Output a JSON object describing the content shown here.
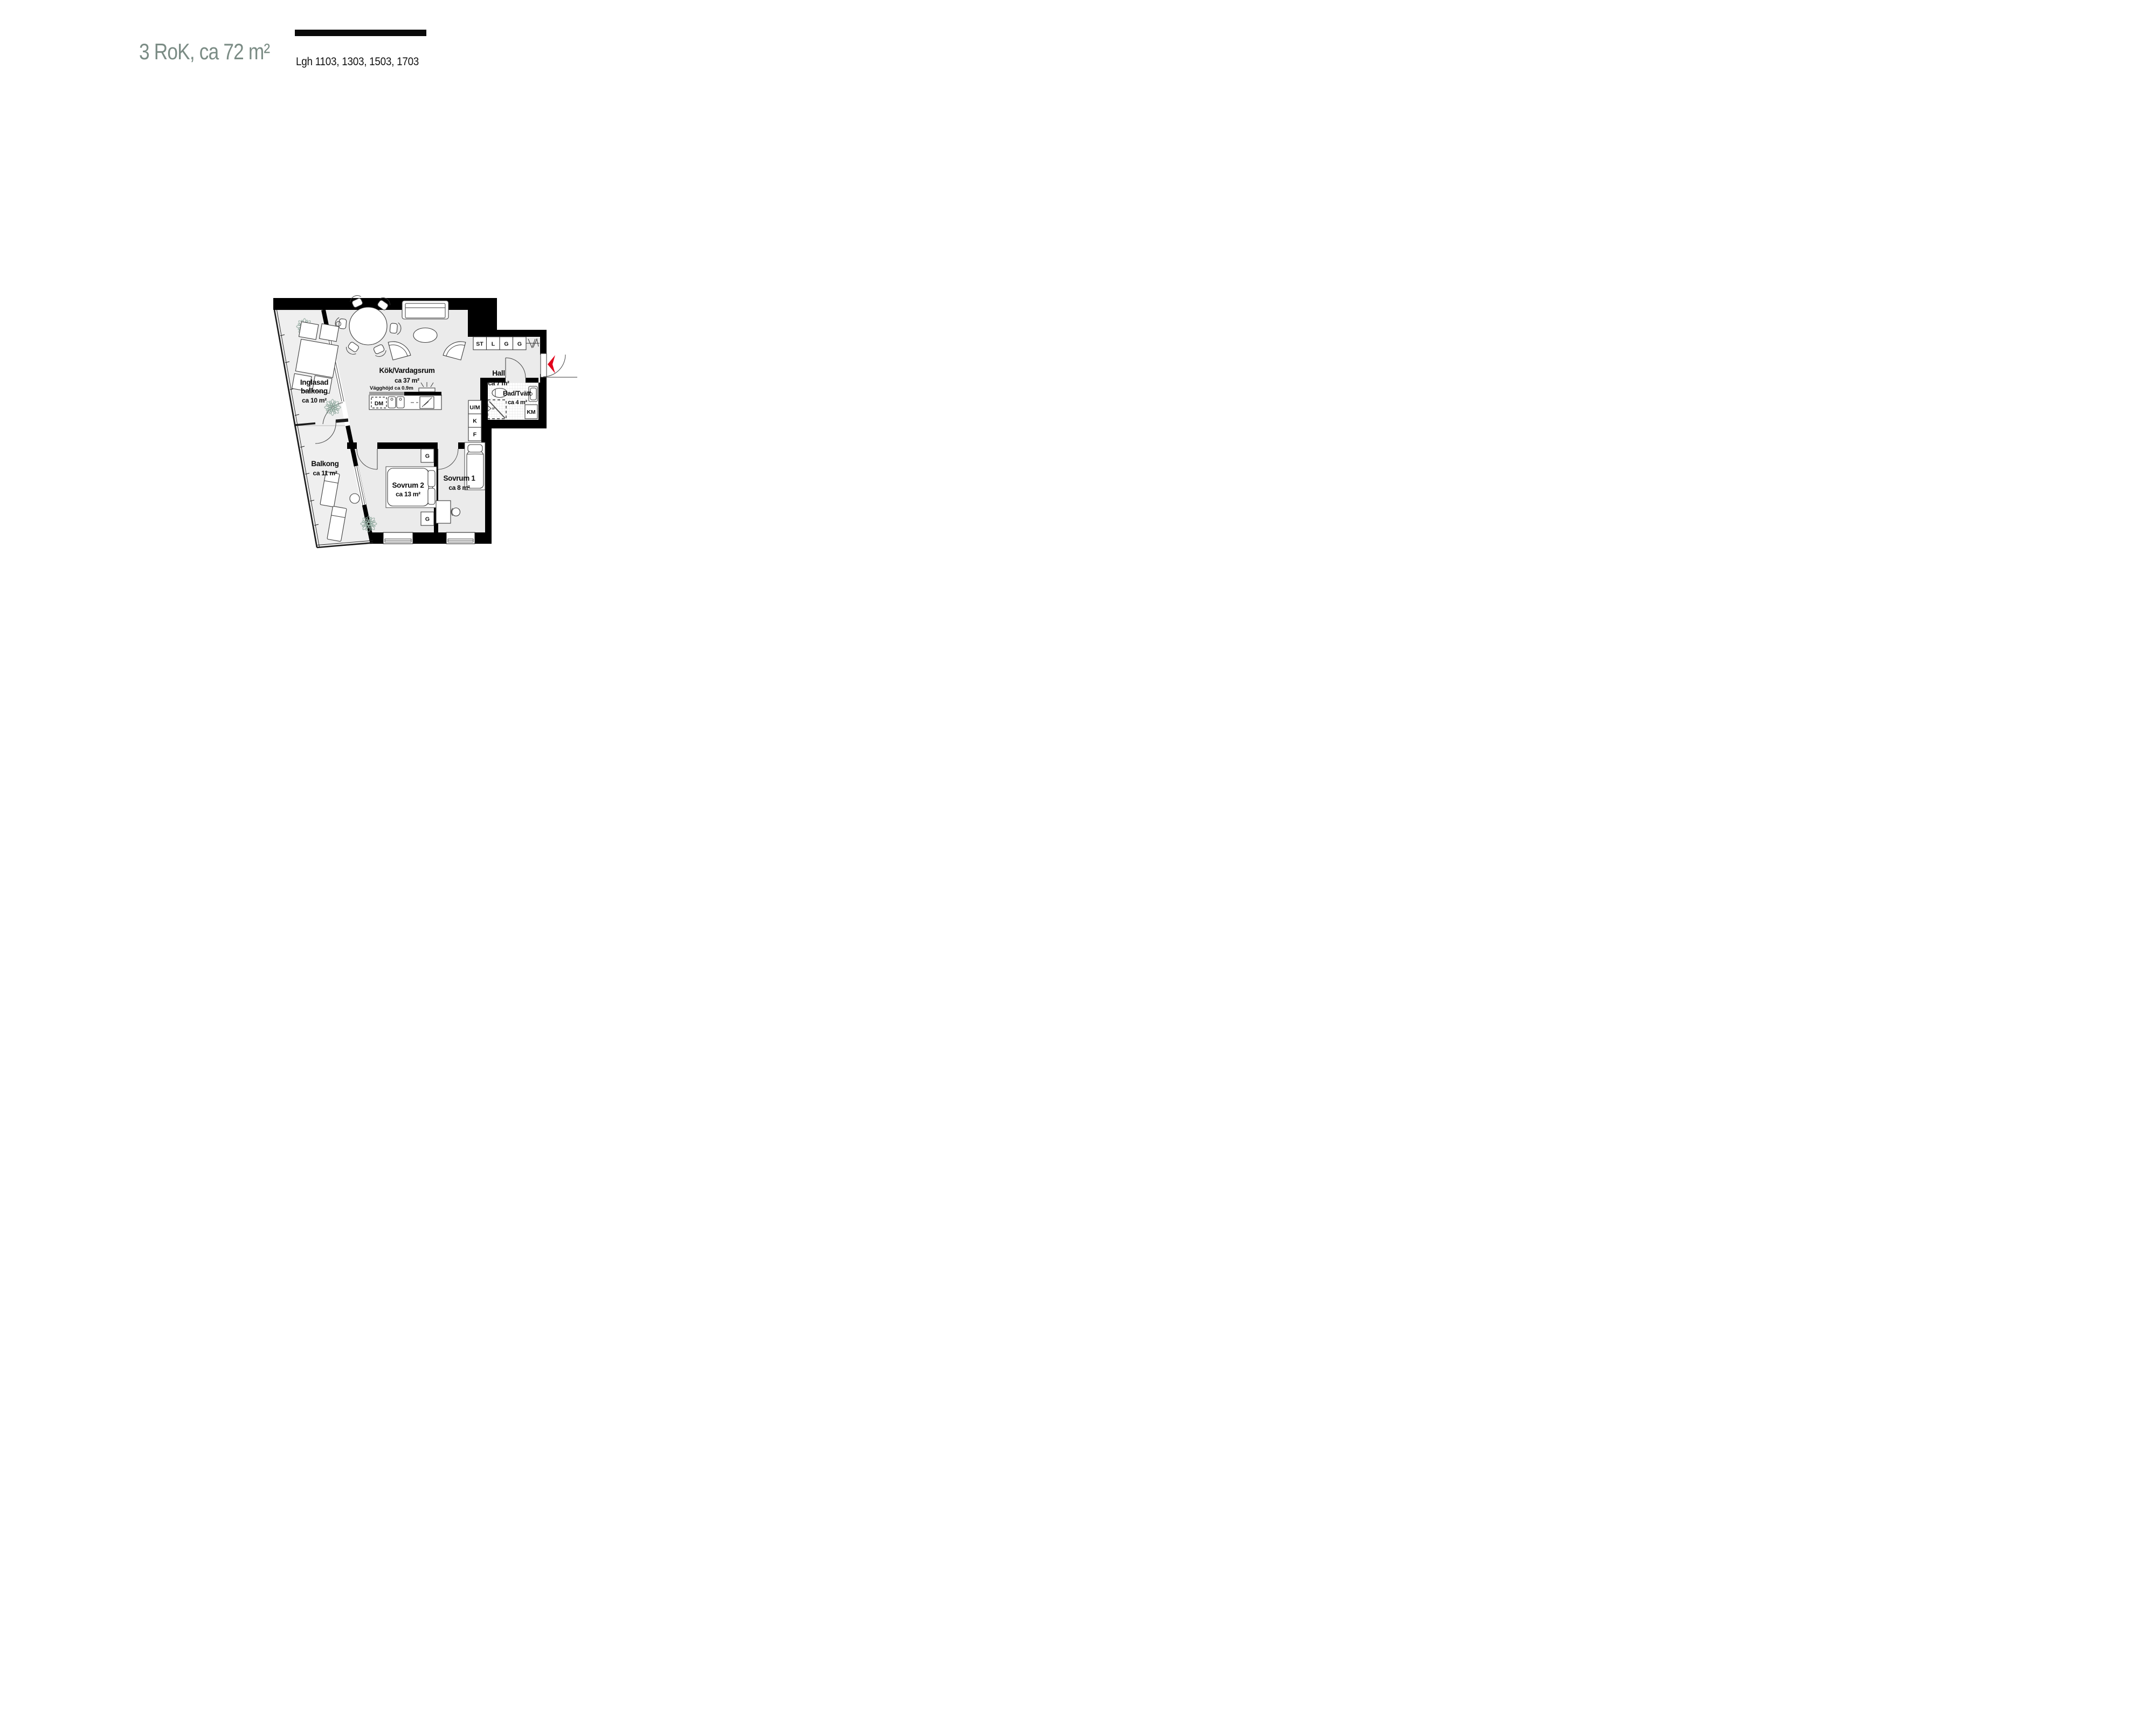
{
  "header": {
    "title": "3 RoK, ca 72 m²",
    "apartments": "Lgh 1103, 1303, 1503, 1703"
  },
  "colors": {
    "title_accent": "#7b8c85",
    "wall": "#000000",
    "floor": "#ebebeb",
    "balcony_floor": "#efefef",
    "plant_green": "#8da69b",
    "entrance_arrow_red": "#e2001a"
  },
  "rooms": {
    "kitchen_living": {
      "name": "Kök/Vardagsrum",
      "area": "ca 37 m²"
    },
    "hall": {
      "name": "Hall",
      "area": "ca 7 m²"
    },
    "bath": {
      "name": "Bad/Tvätt",
      "area": "ca 4 m²"
    },
    "bedroom2": {
      "name": "Sovrum 2",
      "area": "ca 13 m²"
    },
    "bedroom1": {
      "name": "Sovrum 1",
      "area": "ca 8 m²"
    },
    "glazed_balcony": {
      "name_line1": "Inglasad",
      "name_line2": "balkong",
      "area": "ca 10 m²"
    },
    "balcony": {
      "name": "Balkong",
      "area": "ca 11 m²"
    }
  },
  "labels": {
    "wall_height_note": "Vägghöjd ca 0.9m",
    "dishwasher": "DM",
    "washing_machine": "KM",
    "oven_microwave": "U/M",
    "fridge": "K",
    "freezer": "F",
    "closets": [
      "ST",
      "L",
      "G",
      "G"
    ],
    "wardrobe": "G"
  }
}
